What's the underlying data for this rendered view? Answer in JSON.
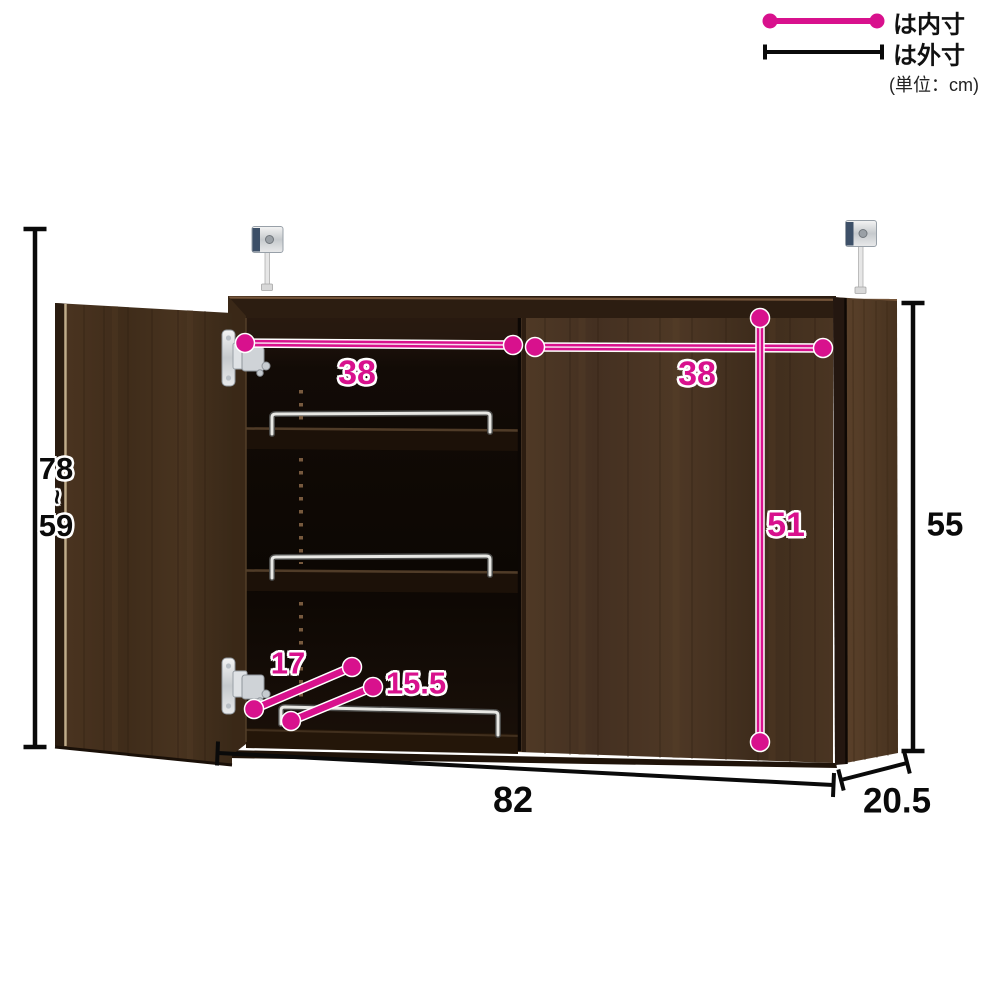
{
  "legend": {
    "inner_label": "は内寸",
    "outer_label": "は外寸",
    "unit": "(単位：cm)"
  },
  "dimensions": {
    "inner_width_left": "38",
    "inner_width_right": "38",
    "inner_height": "51",
    "outer_height": "55",
    "outer_height_range_max": "78",
    "outer_height_range_tilde": "~",
    "outer_height_range_min": "59",
    "inner_depth_top": "17",
    "inner_depth_shelf": "15.5",
    "outer_width": "82",
    "outer_depth": "20.5"
  },
  "colors": {
    "inner_dimension_pink": "#d8118d",
    "outer_dimension_black": "#0a0a0a",
    "cabinet_wood_dark": "#46311f",
    "cabinet_interior": "#100a05"
  }
}
